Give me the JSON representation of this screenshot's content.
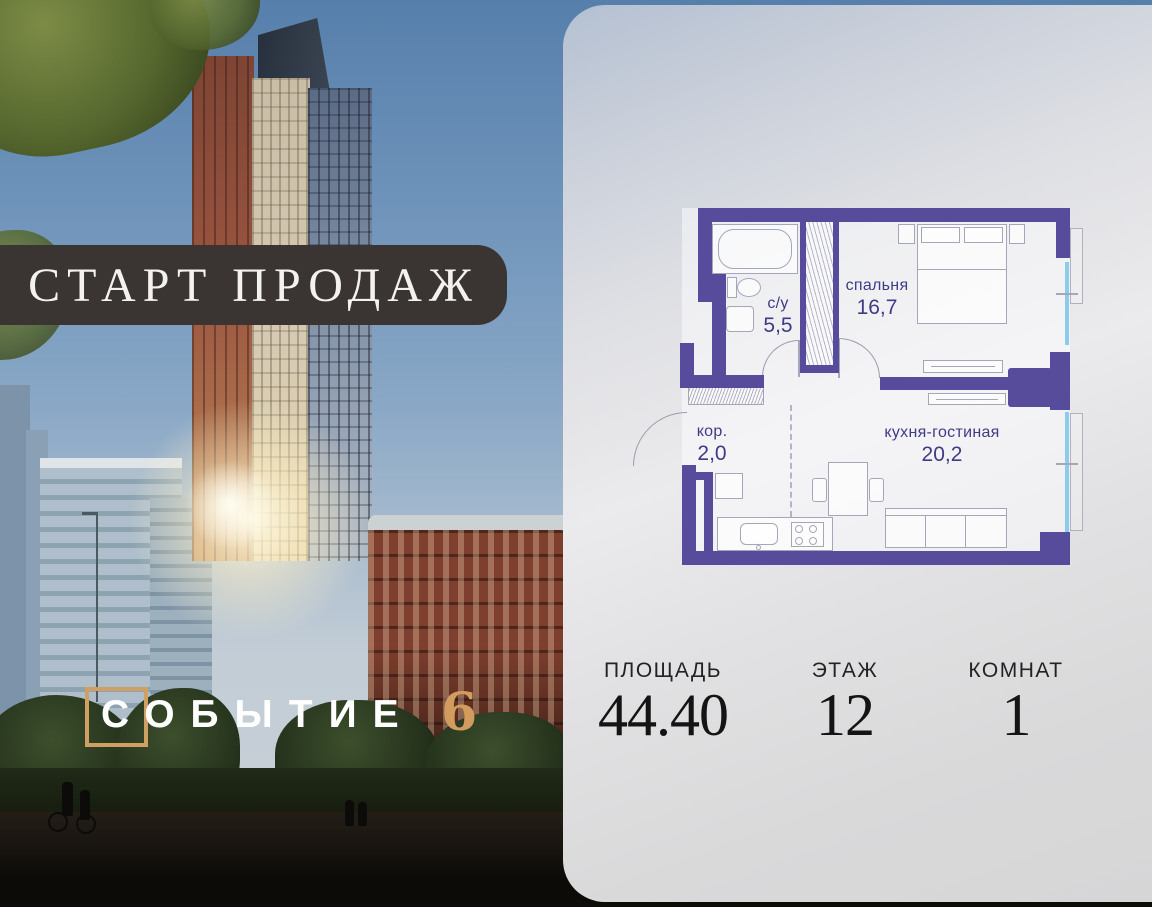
{
  "banner": {
    "label": "СТАРТ ПРОДАЖ"
  },
  "logo": {
    "name": "СОБЫТИЕ",
    "number": "6"
  },
  "floorplan": {
    "rooms": [
      {
        "name": "с/у",
        "area": "5,5"
      },
      {
        "name": "спальня",
        "area": "16,7"
      },
      {
        "name": "кор.",
        "area": "2,0"
      },
      {
        "name": "кухня-гостиная",
        "area": "20,2"
      }
    ]
  },
  "stats": [
    {
      "label": "ПЛОЩАДЬ",
      "value": "44.40"
    },
    {
      "label": "ЭТАЖ",
      "value": "12"
    },
    {
      "label": "КОМНАТ",
      "value": "1"
    }
  ],
  "colors": {
    "wall_purple": "#574b9c",
    "label_indigo": "#3f3b85",
    "window_blue": "#8ccbe9",
    "banner_bg": "#3a3533",
    "logo_gold": "#cfa061",
    "stats_text": "#141414"
  }
}
